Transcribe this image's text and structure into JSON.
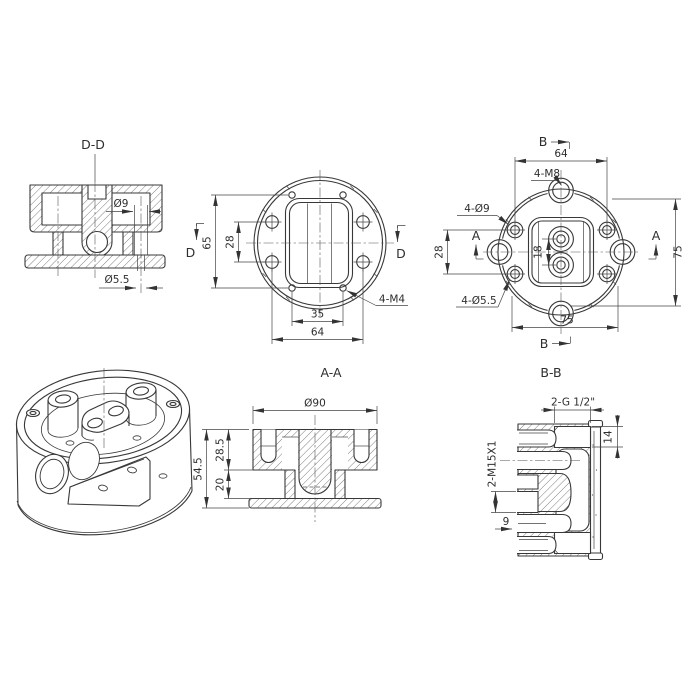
{
  "views": {
    "section_dd": {
      "label": "D-D",
      "dia9": "Ø9",
      "dia55": "Ø5.5"
    },
    "top_view": {
      "cut_label": "D",
      "dim_v65": "65",
      "dim_v28": "28",
      "dim_h35": "35",
      "dim_h64": "64",
      "callout_m4": "4-M4"
    },
    "bottom_view": {
      "cut_b": "B",
      "cut_a": "A",
      "dim_top64": "64",
      "callout_m8": "4-M8",
      "callout_d9": "4-Ø9",
      "callout_d55": "4-Ø5.5",
      "dim_28": "28",
      "dim_18": "18",
      "dim_75_right": "75",
      "dim_75_bottom": "75"
    },
    "section_aa": {
      "label": "A-A",
      "dia90": "Ø90",
      "dim_545": "54.5",
      "dim_285": "28.5",
      "dim_20": "20"
    },
    "section_bb": {
      "label": "B-B",
      "callout_g": "2-G 1/2\"",
      "dim_14": "14",
      "callout_m15": "2-M15X1",
      "dim_9": "9"
    }
  }
}
